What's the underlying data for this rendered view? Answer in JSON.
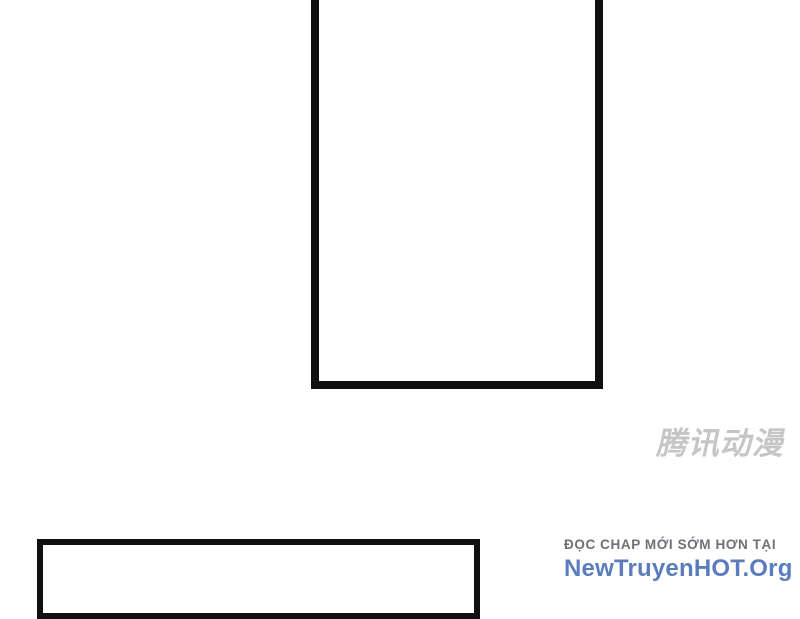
{
  "page": {
    "background_color": "#ffffff",
    "panel_border_color": "#101010"
  },
  "watermark": {
    "text": "腾讯动漫",
    "color": "#c6c6c6"
  },
  "footer": {
    "tagline": "ĐỌC CHAP MỚI SỚM HƠN TẠI",
    "tagline_color": "#6d7076",
    "site_name": "NewTruyenHOT.Org",
    "site_color": "#5b7dbd"
  }
}
